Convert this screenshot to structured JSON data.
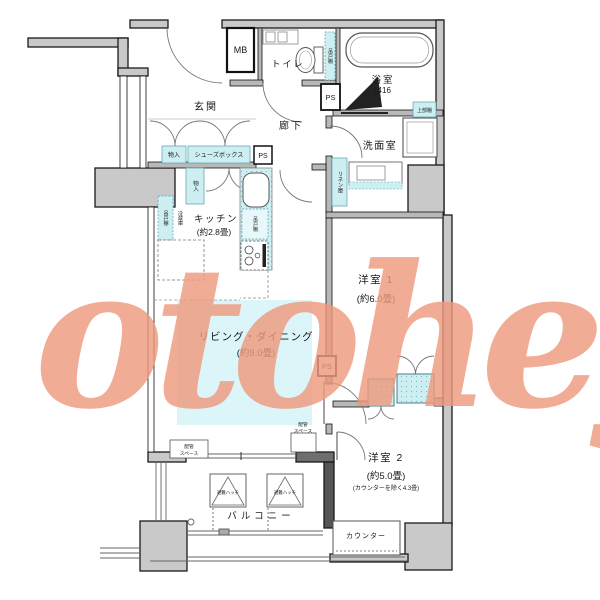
{
  "watermark": {
    "text": "otoheya",
    "color": "#ef9a7e"
  },
  "colors": {
    "wall_gray": "#c9c9c9",
    "fixture_cyan": "#cdeff2",
    "ld_highlight": "#dcf5f8"
  },
  "rooms": {
    "entrance": {
      "label": "玄関"
    },
    "hallway": {
      "label": "廊下"
    },
    "toilet": {
      "label": "トイレ"
    },
    "bathroom": {
      "label": "浴室",
      "size": "1416"
    },
    "washroom": {
      "label": "洗面室"
    },
    "kitchen": {
      "label": "キッチン",
      "size": "(約2.8畳)"
    },
    "living_dining": {
      "label": "リビング・ダイニング",
      "size": "(約9.0畳)"
    },
    "western_room_1": {
      "label": "洋室 1",
      "size": "(約6.0畳)"
    },
    "western_room_2": {
      "label": "洋室 2",
      "size": "(約5.0畳)",
      "note": "(カウンターを除く4.3畳)"
    },
    "balcony": {
      "label": "バルコニー"
    }
  },
  "fixtures": {
    "meter_box": "MB",
    "pipe_space": "PS",
    "shoe_box": "シューズボックス",
    "storage": "物入",
    "linen_closet": "リネン庫",
    "upper_shelf": "上部棚",
    "hanging_cupboard": "吊戸棚",
    "refrigerator": "冷蔵庫",
    "counter": "カウンター",
    "escape_hatch": "避難ハッチ",
    "pipe_space_note_line1": "配管",
    "pipe_space_note_line2": "スペース"
  }
}
